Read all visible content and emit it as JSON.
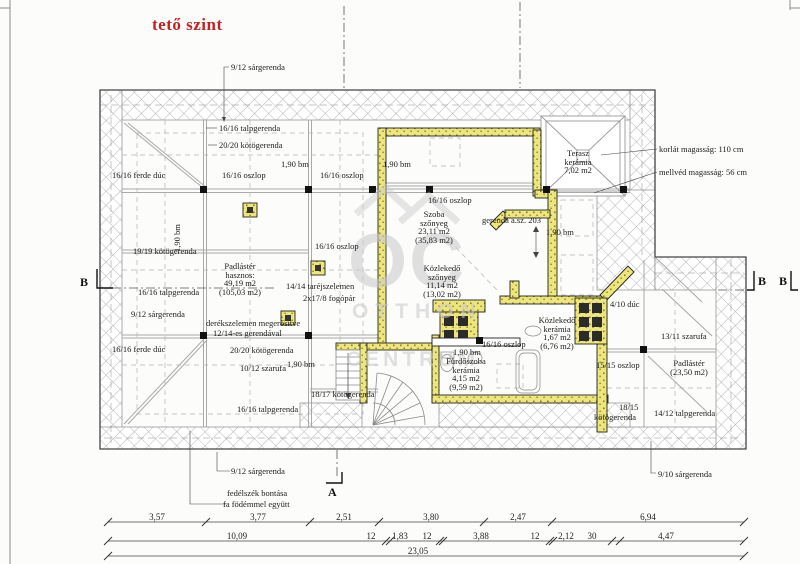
{
  "title": "tető szint",
  "watermark": {
    "monogram": "OC",
    "line1": "OTTHON",
    "line2": "CENTRUM"
  },
  "section_markers": {
    "left": "B",
    "right": "B B",
    "bottom": "A"
  },
  "annotations": [
    "9/12 sárgerenda",
    "16/16 talpgerenda",
    "20/20 kötögerenda",
    "1,90 bm",
    "1,90 bm",
    "16/16 ferde dúc",
    "16/16 oszlop",
    "16/16 oszlop",
    "1,90 bm",
    "19/19 kötögerenda",
    "16/16 talpgerenda",
    "9/12 sárgerenda",
    "derékszelemen megerősítve",
    "12/14-es gerendával",
    "16/16 ferde dúc",
    "20/20 kötögerenda",
    "10/12 szarufa",
    "1,90 bm",
    "16/16 talpgerenda",
    "18/17 kötögerenda",
    "14/14 taréjszelemen",
    "2x17/8 fogópár",
    "16/16 oszlop",
    "16/16 oszlop",
    "16/16 oszlop",
    "1,90 bm",
    "1,90 bm",
    "gerenda a.sz. 203",
    "korlát magasság: 110 cm",
    "mellvéd magasság: 56 cm",
    "4/10 dúc",
    "13/11 szarufa",
    "15/15 oszlop",
    "18/15",
    "kötögerenda",
    "14/12 talpgerenda",
    "9/10 sárgerenda",
    "9/12 sárgerenda",
    "fedélszék bontása",
    "fa födémmel együtt"
  ],
  "rooms": {
    "padlaster_main": [
      "Padlástér",
      "hasznos:",
      "49,19 m2",
      "(105,03 m2)"
    ],
    "terasz": [
      "Terasz",
      "kerámia",
      "7,02 m2"
    ],
    "szoba": [
      "Szoba",
      "szőnyeg",
      "23,11 m2",
      "(35,83 m2)"
    ],
    "kozlekedo_szonyeg": [
      "Közlekedő",
      "szőnyeg",
      "11,14 m2",
      "(13,02 m2)"
    ],
    "kozlekedo_keramia": [
      "Közlekedő",
      "kerámia",
      "1,67 m2",
      "(6,76 m2)"
    ],
    "furdoszoba": [
      "Fürdőszoba",
      "kerámia",
      "4,15 m2",
      "(9,59 m2)"
    ],
    "padlaster_small": [
      "Padlástér",
      "(23,50 m2)"
    ]
  },
  "dimensions": {
    "row1": [
      "3,57",
      "3,77",
      "2,51",
      "3,80",
      "2,47",
      "6,94"
    ],
    "row2": [
      "10,09",
      "12",
      "1,83",
      "12",
      "3,88",
      "12",
      "2,12",
      "30",
      "4,47"
    ],
    "total": "23,05"
  },
  "colors": {
    "accent_red": "#c32222",
    "wall_yellow": "#ece67c",
    "hatch_grey": "#a2a2a2",
    "watermark_grey": "#c9c9c9"
  }
}
